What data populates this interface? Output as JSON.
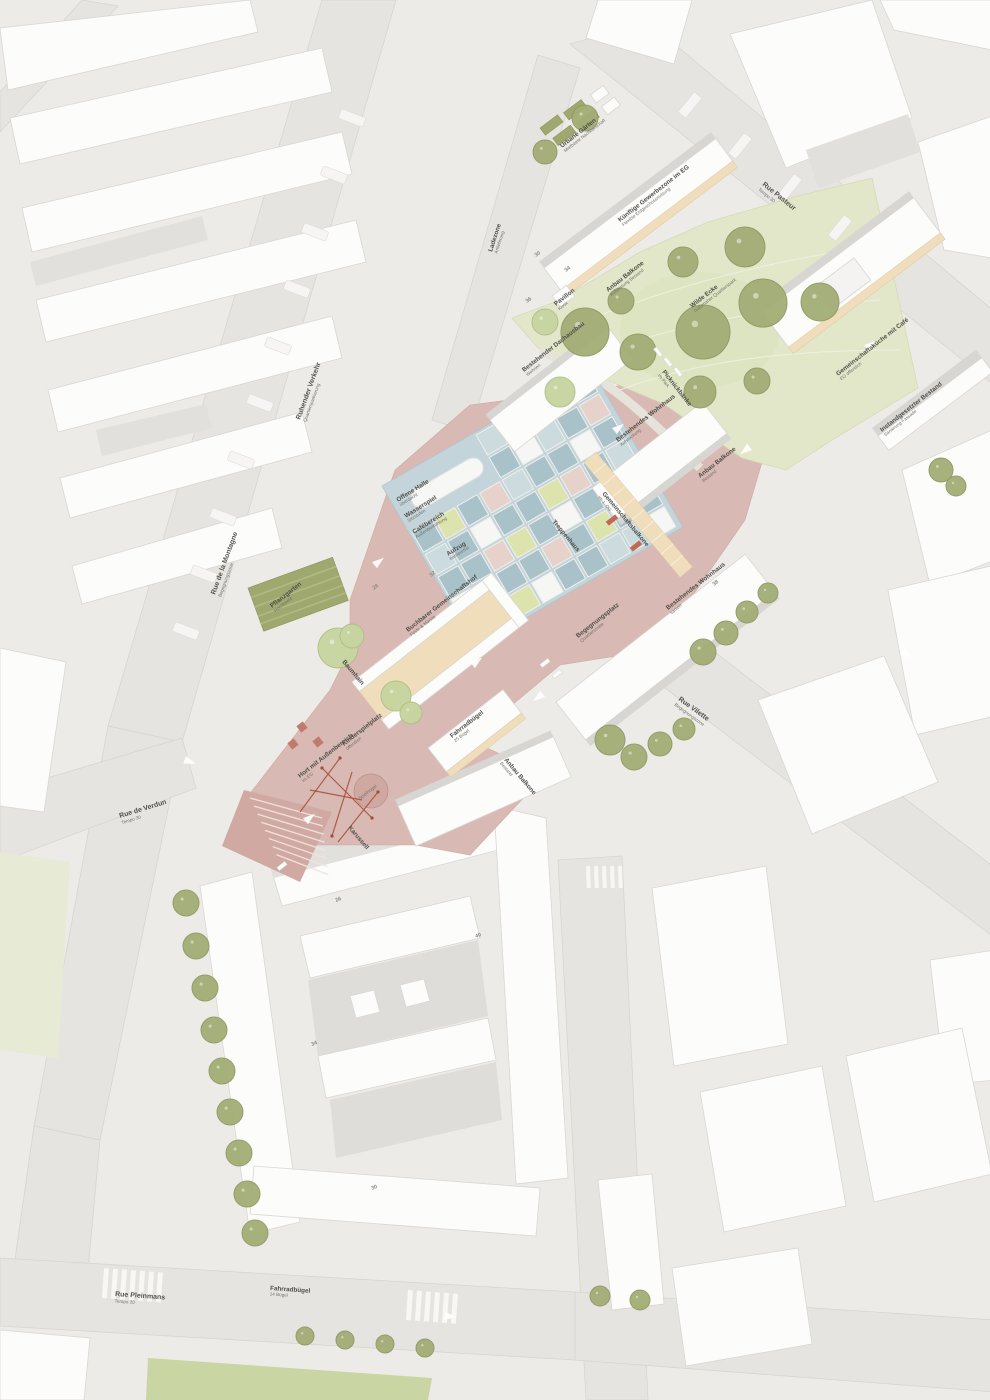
{
  "streets": {
    "montagne": {
      "name": "Rue de la Montagne",
      "sub": "Begegnungszone"
    },
    "verkehr": {
      "name": "Ruhender Verkehr",
      "sub": "Quartiersparkierung"
    },
    "verdun": {
      "name": "Rue de Verdun",
      "sub": "Tempo 30"
    },
    "pasteur": {
      "name": "Rue Pasteur",
      "sub": "Tempo 30"
    },
    "vilette": {
      "name": "Rue Vilette",
      "sub": "Begegnungszone"
    },
    "pleinmans": {
      "name": "Rue Pleinmans",
      "sub": "Tempo 20"
    }
  },
  "site": {
    "urbane_gaerten": {
      "t": "Urbane Gärten",
      "s": "Mietbeete Nachbarschaft"
    },
    "gewerbe": {
      "t": "Künftige Gewerbezone im EG",
      "s": "Flexible Erdgeschossnutzung"
    },
    "balkone1": {
      "t": "Anbau Balkone",
      "s": "Aufwertung Bestand"
    },
    "wilde_ecke": {
      "t": "Wilde Ecke",
      "s": "Naturnaher Quartierspark"
    },
    "ladezone": {
      "t": "Ladezone",
      "s": "Anlieferung"
    },
    "pavillon": {
      "t": "Pavillon",
      "s": "Kiosk"
    },
    "dachausbau": {
      "t": "Bestehender Dachausbau",
      "s": "Wohnen"
    },
    "picknick": {
      "t": "Picknickbänke",
      "s": "im Park"
    },
    "kueche": {
      "t": "Gemeinschaftsküche mit Café",
      "s": "EG öffentlich"
    },
    "instand": {
      "t": "Instandgesetzter Bestand",
      "s": "Sanierung Fassade"
    },
    "wohnhaus1": {
      "t": "Bestehendes Wohnhaus",
      "s": "Aufstockung"
    },
    "balkone2": {
      "t": "Anbau Balkone",
      "s": "Bestand"
    },
    "halle": {
      "t": "Offene Halle",
      "s": "überdacht"
    },
    "wasserspiel": {
      "t": "Wasserspiel",
      "s": "Sitzstufen"
    },
    "cafe": {
      "t": "Cafébereich",
      "s": "Außenbestuhlung"
    },
    "aufzug": {
      "t": "Aufzug",
      "s": "barrierefrei"
    },
    "gem_balkone": {
      "t": "Gemeinschaftsbalkone",
      "s": "im 1. OG"
    },
    "treppe": {
      "t": "Treppenhaus",
      "s": ""
    },
    "begegnung": {
      "t": "Begegnungsplatz",
      "s": "Quartiersmitte"
    },
    "wohnhaus2": {
      "t": "Bestehendes Wohnhaus",
      "s": "saniert"
    },
    "hof": {
      "t": "Buchbarer Gemeinschaftshof",
      "s": "Feste & Märkte"
    },
    "pflanz": {
      "t": "Pflanzgarten",
      "s": "Hochbeete"
    },
    "baumhain": {
      "t": "Baumhain",
      "s": ""
    },
    "kispiel": {
      "t": "Kinderspielplatz",
      "s": "öffentlich"
    },
    "hort": {
      "t": "Hort mit Außenbereich",
      "s": "im EG"
    },
    "karussell": {
      "t": "Karussell",
      "s": ""
    },
    "huegel": {
      "t": "Spielhügel",
      "s": ""
    },
    "fahrrad1": {
      "t": "Fahrradbügel",
      "s": "25 Bügel"
    },
    "balkone3": {
      "t": "Anbau Balkone",
      "s": "Bestand"
    },
    "fahrrad2": {
      "t": "Fahrradbügel",
      "s": "14 Bügel"
    }
  },
  "numbers": [
    "30",
    "34",
    "36",
    "32",
    "28",
    "38",
    "26",
    "40",
    "34",
    "30"
  ],
  "colors": {
    "paper": "#edebe7",
    "road": "#e6e4e0",
    "building": "#fcfcfb",
    "plaza_pink": "#d8b9b3",
    "water_blue": "#c3d5da",
    "park_green": "#e2e7c9",
    "tree_olive": "#a6b07c",
    "balcony_tan": "#efddbc",
    "accent_red": "#b85c44"
  }
}
